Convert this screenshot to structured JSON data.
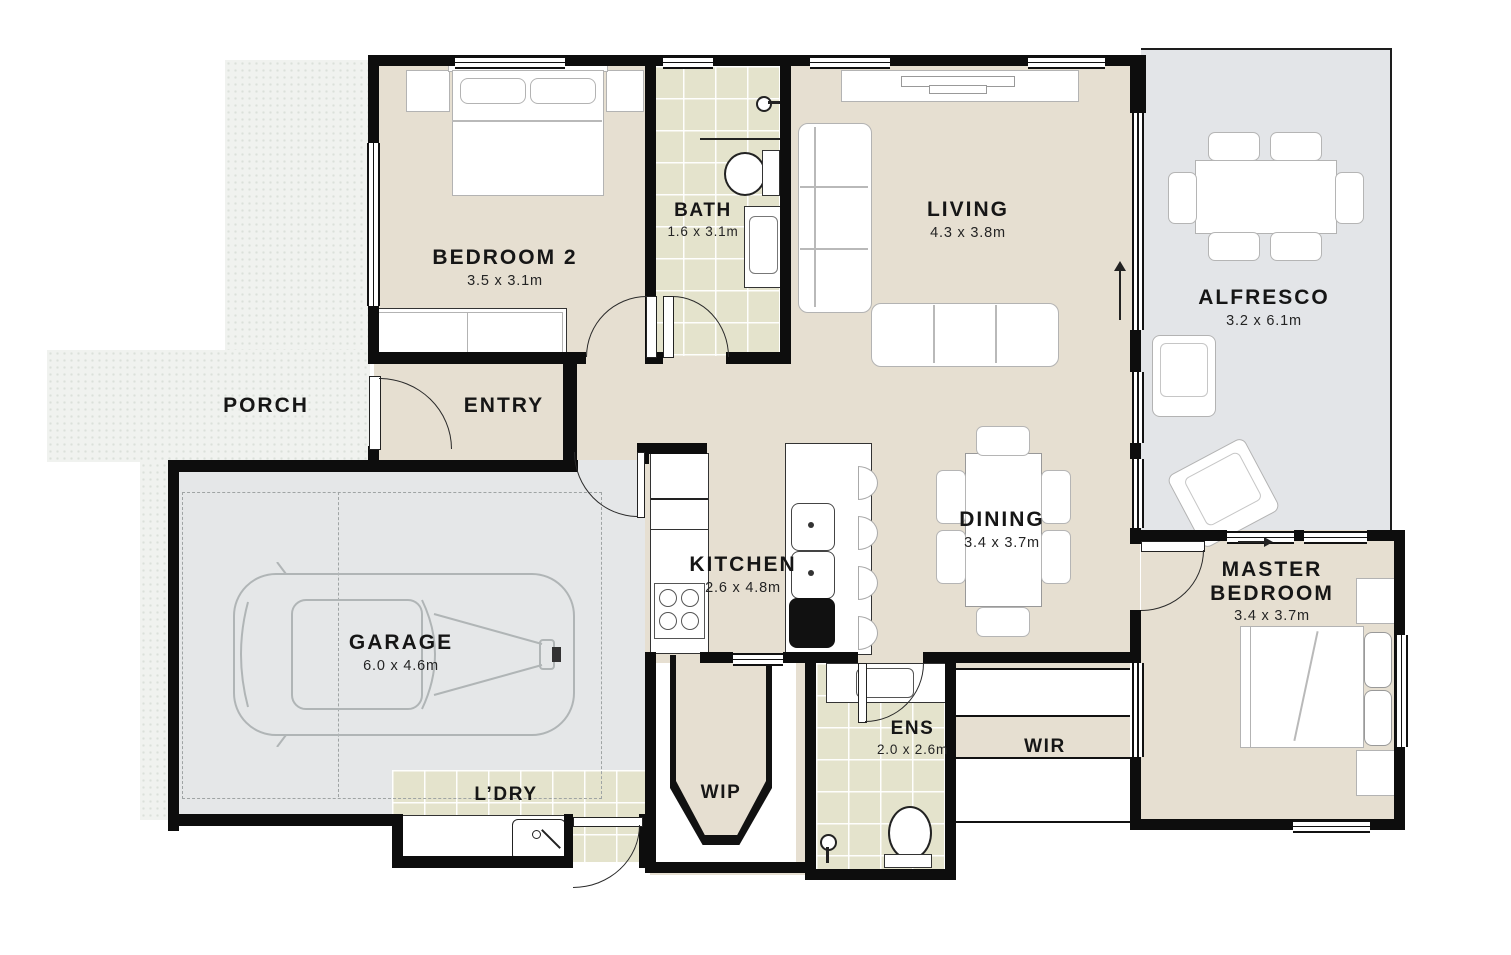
{
  "title": "Residential floor plan",
  "colors": {
    "floor_beige": "#e6dfd1",
    "tile": "#e4e3cc",
    "garage_gray": "#e5e7e8",
    "alfresco_gray": "#e3e5e8",
    "porch": "#f0f2ef",
    "wall": "#0d0d0d",
    "text": "#161616"
  },
  "rooms": [
    {
      "id": "porch",
      "name": "PORCH",
      "dims": ""
    },
    {
      "id": "bedroom-2",
      "name": "BEDROOM 2",
      "dims": "3.5 x 3.1m"
    },
    {
      "id": "bath",
      "name": "BATH",
      "dims": "1.6 x 3.1m"
    },
    {
      "id": "living",
      "name": "LIVING",
      "dims": "4.3 x 3.8m"
    },
    {
      "id": "alfresco",
      "name": "ALFRESCO",
      "dims": "3.2 x 6.1m"
    },
    {
      "id": "entry",
      "name": "ENTRY",
      "dims": ""
    },
    {
      "id": "garage",
      "name": "GARAGE",
      "dims": "6.0 x 4.6m"
    },
    {
      "id": "kitchen",
      "name": "KITCHEN",
      "dims": "2.6 x 4.8m"
    },
    {
      "id": "dining",
      "name": "DINING",
      "dims": "3.4 x 3.7m"
    },
    {
      "id": "master-bedroom",
      "name": "MASTER BEDROOM",
      "dims": "3.4 x 3.7m"
    },
    {
      "id": "laundry",
      "name": "L’DRY",
      "dims": ""
    },
    {
      "id": "wip",
      "name": "WIP",
      "dims": ""
    },
    {
      "id": "ens",
      "name": "ENS",
      "dims": "2.0 x 2.6m"
    },
    {
      "id": "wir",
      "name": "WIR",
      "dims": ""
    }
  ]
}
